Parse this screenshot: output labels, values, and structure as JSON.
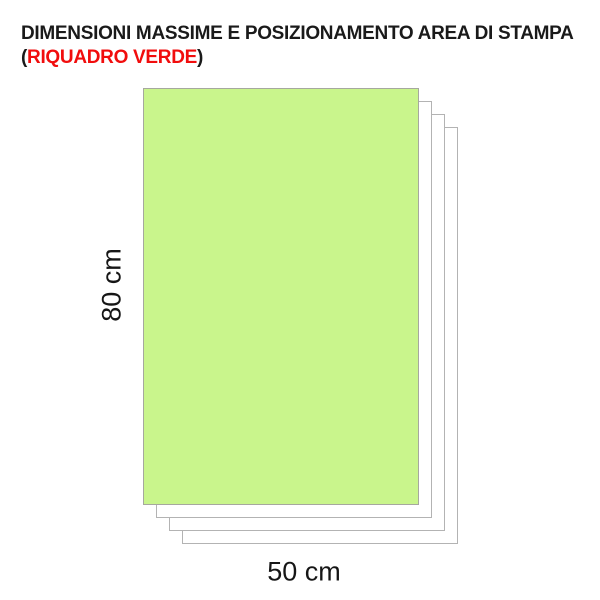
{
  "title": {
    "line1": "DIMENSIONI MASSIME E POSIZIONAMENTO AREA DI STAMPA",
    "line2_open_paren": "(",
    "line2_highlight": "RIQUADRO VERDE",
    "line2_close_paren": ")"
  },
  "diagram": {
    "print_area": {
      "height_label": "80 cm",
      "width_label": "50 cm",
      "fill_color": "#C9F58C",
      "border_color": "#A6A89E"
    },
    "stacked_sheets": {
      "count": 4,
      "fill_color": "#FFFFFF",
      "border_color": "#B3B3B3"
    }
  },
  "colors": {
    "title_text": "#1A1A1A",
    "highlight_red": "#F10D0D",
    "background": "#FFFFFF"
  }
}
